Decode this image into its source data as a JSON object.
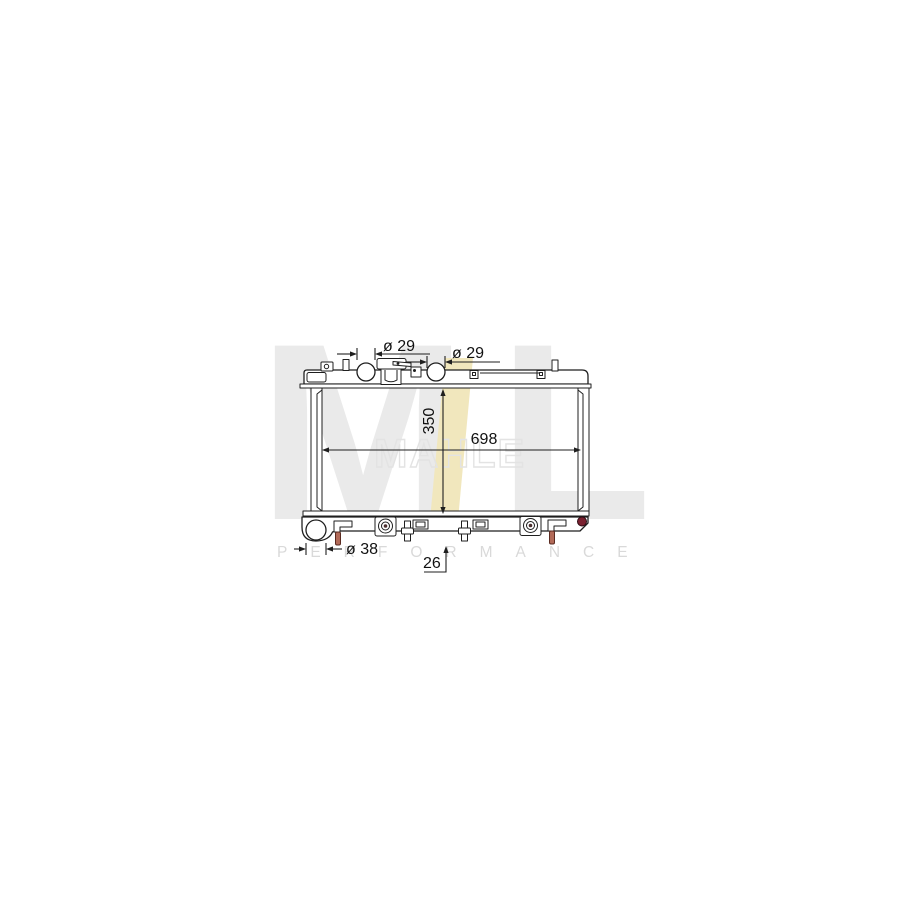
{
  "watermark": {
    "monogram_left": "M",
    "monogram_right": "L",
    "wordmark": "MAHLE",
    "tagline": "PERFORMANCE",
    "monogram_gray": "#eaeaea",
    "wordmark_outline_gray": "#e3e3e3",
    "tagline_gray": "#d9d9d9",
    "accent_yellow": "#f1e7bd"
  },
  "drawing": {
    "line_color": "#1f1f1f",
    "pin_red": "#b26a58",
    "drain_plug_red": "#7a2130",
    "dims": {
      "top_left_port": "ø 29",
      "top_right_port": "ø 29",
      "core_height": "350",
      "core_width": "698",
      "bottom_port": "ø 38",
      "bracket_offset": "26"
    }
  }
}
